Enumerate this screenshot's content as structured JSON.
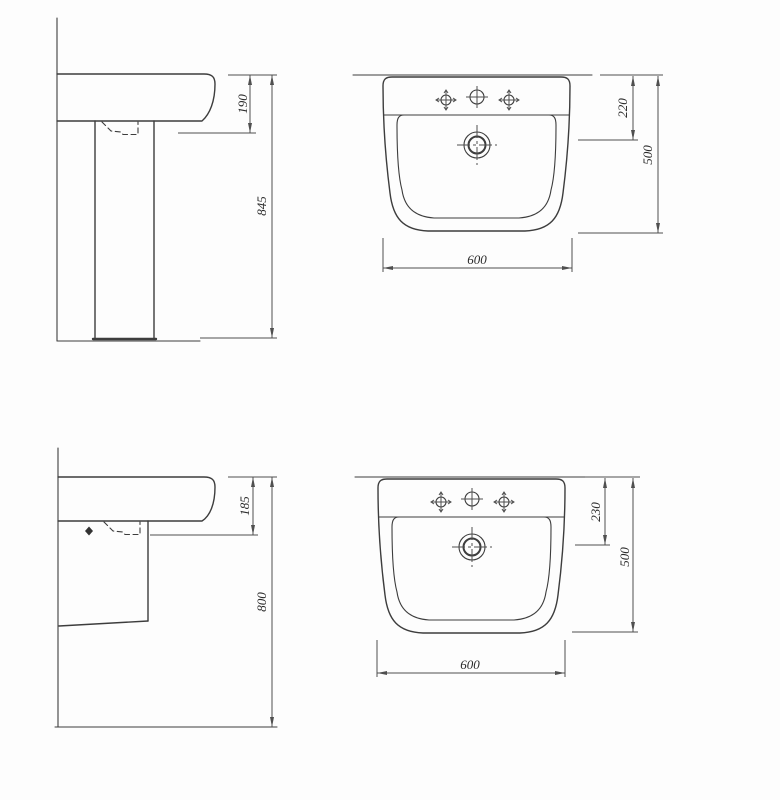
{
  "drawing": {
    "views": {
      "pedestal_side": {
        "basin_front_height": "190",
        "height_total": "845"
      },
      "pedestal_plan": {
        "tap_to_drain": "220",
        "depth": "500",
        "width": "600"
      },
      "semipedestal_side": {
        "basin_front_height": "185",
        "height_total": "800"
      },
      "semipedestal_plan": {
        "tap_to_drain": "230",
        "depth": "500",
        "width": "600"
      }
    },
    "colors": {
      "outline": "#3d3d3d",
      "dimension_line": "#4f4f4f",
      "label_text": "#2b2b2b",
      "background": "#fdfdfd"
    }
  }
}
